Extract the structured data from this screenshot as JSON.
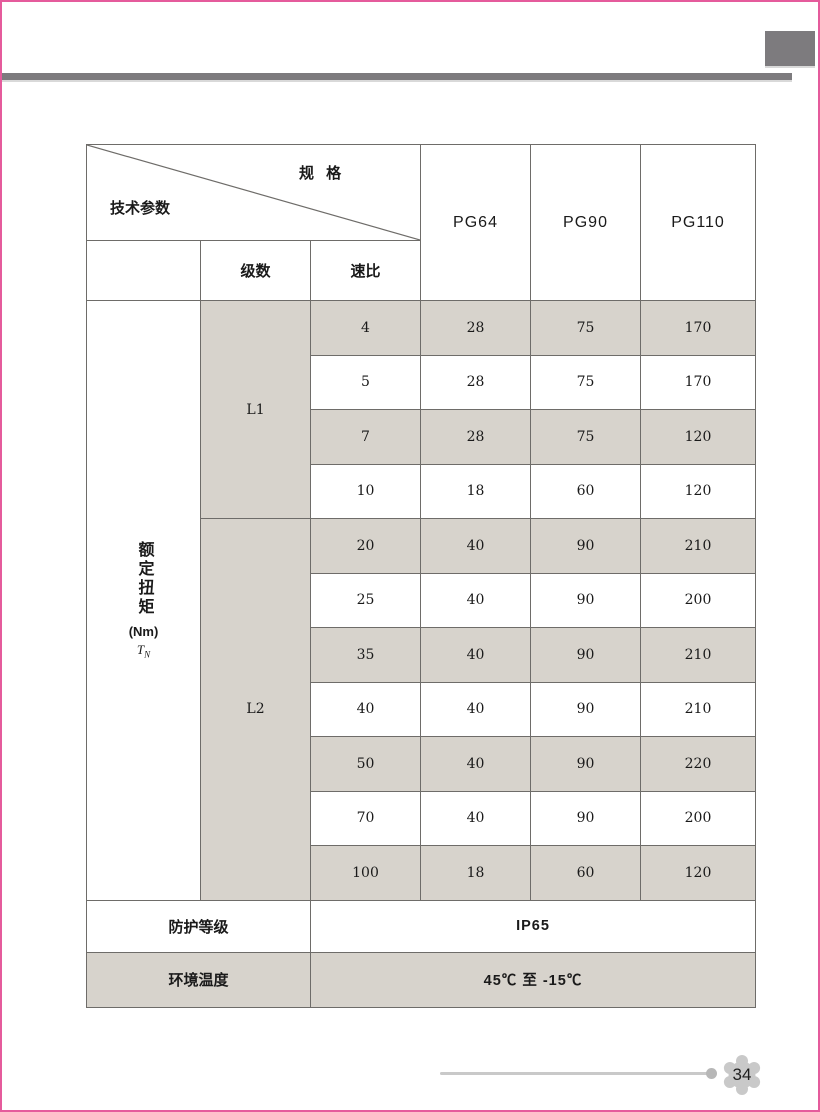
{
  "page": {
    "number": "34"
  },
  "colors": {
    "accent_pink": "#e55b9c",
    "bar_gray": "#7d7b7e",
    "cell_shade": "#d7d3cc",
    "grid_line": "#6e6c69",
    "footer_gray": "#c9c9c9"
  },
  "table": {
    "corner": {
      "spec_label": "规 格",
      "params_label": "技术参数"
    },
    "columns": [
      "PG64",
      "PG90",
      "PG110"
    ],
    "sub_header": {
      "stage": "级数",
      "ratio": "速比"
    },
    "torque": {
      "name": "额定扭矩",
      "unit": "(Nm)",
      "symbol": "T",
      "symbol_sub": "N"
    },
    "groups": [
      {
        "stage": "L1",
        "rows": [
          {
            "ratio": "4",
            "pg64": "28",
            "pg90": "75",
            "pg110": "170"
          },
          {
            "ratio": "5",
            "pg64": "28",
            "pg90": "75",
            "pg110": "170"
          },
          {
            "ratio": "7",
            "pg64": "28",
            "pg90": "75",
            "pg110": "120"
          },
          {
            "ratio": "10",
            "pg64": "18",
            "pg90": "60",
            "pg110": "120"
          }
        ]
      },
      {
        "stage": "L2",
        "rows": [
          {
            "ratio": "20",
            "pg64": "40",
            "pg90": "90",
            "pg110": "210"
          },
          {
            "ratio": "25",
            "pg64": "40",
            "pg90": "90",
            "pg110": "200"
          },
          {
            "ratio": "35",
            "pg64": "40",
            "pg90": "90",
            "pg110": "210"
          },
          {
            "ratio": "40",
            "pg64": "40",
            "pg90": "90",
            "pg110": "210"
          },
          {
            "ratio": "50",
            "pg64": "40",
            "pg90": "90",
            "pg110": "220"
          },
          {
            "ratio": "70",
            "pg64": "40",
            "pg90": "90",
            "pg110": "200"
          },
          {
            "ratio": "100",
            "pg64": "18",
            "pg90": "60",
            "pg110": "120"
          }
        ]
      }
    ],
    "footer_rows": [
      {
        "label": "防护等级",
        "value": "IP65"
      },
      {
        "label": "环境温度",
        "value": "45℃ 至 -15℃"
      }
    ]
  }
}
